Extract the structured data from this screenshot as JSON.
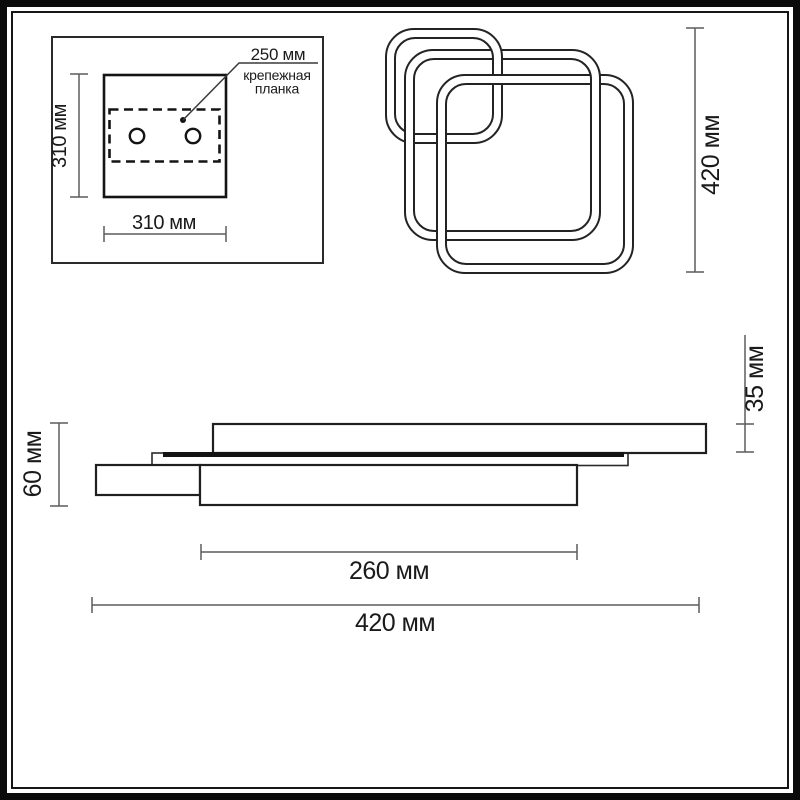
{
  "mounting_plate": {
    "plate_width_label": "310 мм",
    "plate_height_label": "310 мм",
    "bracket_length_label": "250 мм",
    "bracket_name_line1": "крепежная",
    "bracket_name_line2": "планка"
  },
  "top_view": {
    "overall_height_label": "420 мм"
  },
  "side_view": {
    "overall_height_label": "60 мм",
    "top_section_height_label": "35 мм",
    "base_width_label": "260 мм",
    "overall_width_label": "420 мм"
  },
  "colors": {
    "background": "#ffffff",
    "frame": "#0b0b0b",
    "object_line": "#1f1f1f",
    "dimension_line": "#5c5c5c",
    "text": "#1a1a1a",
    "led_strip": "#131313"
  }
}
